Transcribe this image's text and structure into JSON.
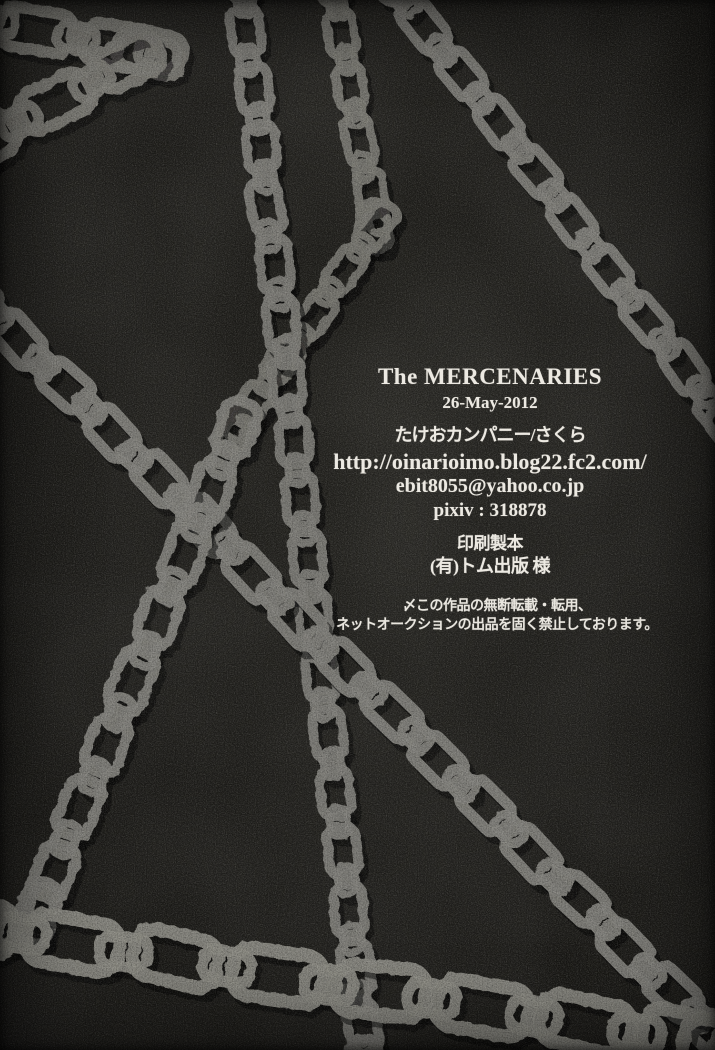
{
  "credits": {
    "title": "The MERCENARIES",
    "date": "26-May-2012",
    "circle": "たけおカンパニー/さくら",
    "website": "http://oinarioimo.blog22.fc2.com/",
    "email": "ebit8055@yahoo.co.jp",
    "pixiv": "pixiv : 318878",
    "printing_heading": "印刷製本",
    "printer": "(有)トム出版 様"
  },
  "notice": {
    "line1": "〆この作品の無断転載・転用、",
    "line2": "ネットオークションの出品を固く禁止しております。"
  },
  "colors": {
    "background": "#1d1c19",
    "chain_gray": "#84837d",
    "text": "#ece9e2"
  },
  "artwork": {
    "description": "crossed chain-link graphics over dark scanned paper"
  }
}
